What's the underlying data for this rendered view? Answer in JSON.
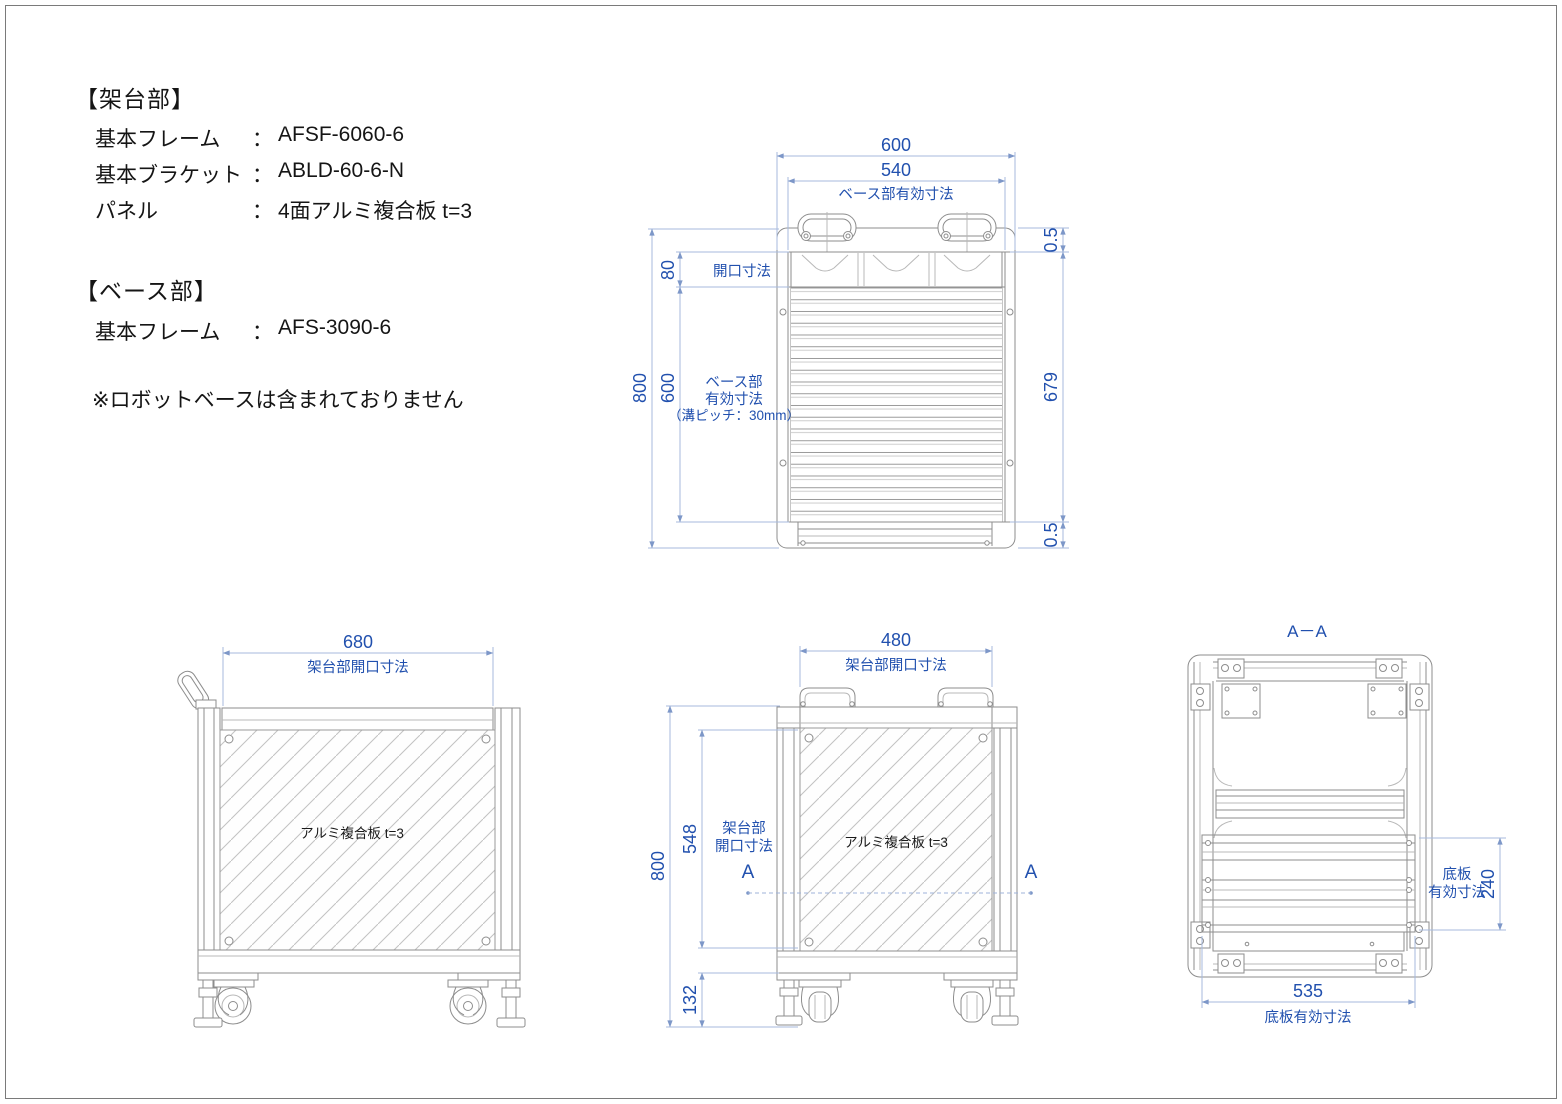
{
  "colors": {
    "dim_text": "#2150ae",
    "dim_line": "#a7badd",
    "object_line": "#8d8d8d",
    "text": "#151515"
  },
  "spec": {
    "frame_section_title": "【架台部】",
    "frame_rows": [
      {
        "label": "基本フレーム",
        "sep": "：",
        "value": "AFSF-6060-6"
      },
      {
        "label": "基本ブラケット",
        "sep": "：",
        "value": "ABLD-60-6-N"
      },
      {
        "label": "パネル",
        "sep": "：",
        "value": "4面アルミ複合板 t=3"
      }
    ],
    "base_section_title": "【ベース部】",
    "base_rows": [
      {
        "label": "基本フレーム",
        "sep": "：",
        "value": "AFS-3090-6"
      }
    ],
    "note": "※ロボットベースは含まれておりません"
  },
  "top_view": {
    "dim_600": "600",
    "dim_540": "540",
    "label_540": "ベース部有効寸法",
    "dim_80": "80",
    "label_80": "開口寸法",
    "dim_800": "800",
    "dim_600_left": "600",
    "label_left_1": "ベース部",
    "label_left_2": "有効寸法",
    "label_left_3": "（溝ピッチ：30mm）",
    "dim_05_top": "0.5",
    "dim_679": "679",
    "dim_05_bottom": "0.5"
  },
  "side_view": {
    "dim_680": "680",
    "label_680": "架台部開口寸法",
    "panel_label": "アルミ複合板 t=3"
  },
  "front_view": {
    "dim_480": "480",
    "label_480": "架台部開口寸法",
    "dim_800": "800",
    "dim_548": "548",
    "label_548_1": "架台部",
    "label_548_2": "開口寸法",
    "dim_132": "132",
    "section_a_left": "A",
    "section_a_right": "A",
    "panel_label": "アルミ複合板 t=3"
  },
  "section_view": {
    "title": "A－A",
    "label_240_1": "底板",
    "label_240_2": "有効寸法",
    "dim_240": "240",
    "dim_535": "535",
    "label_535": "底板有効寸法"
  }
}
